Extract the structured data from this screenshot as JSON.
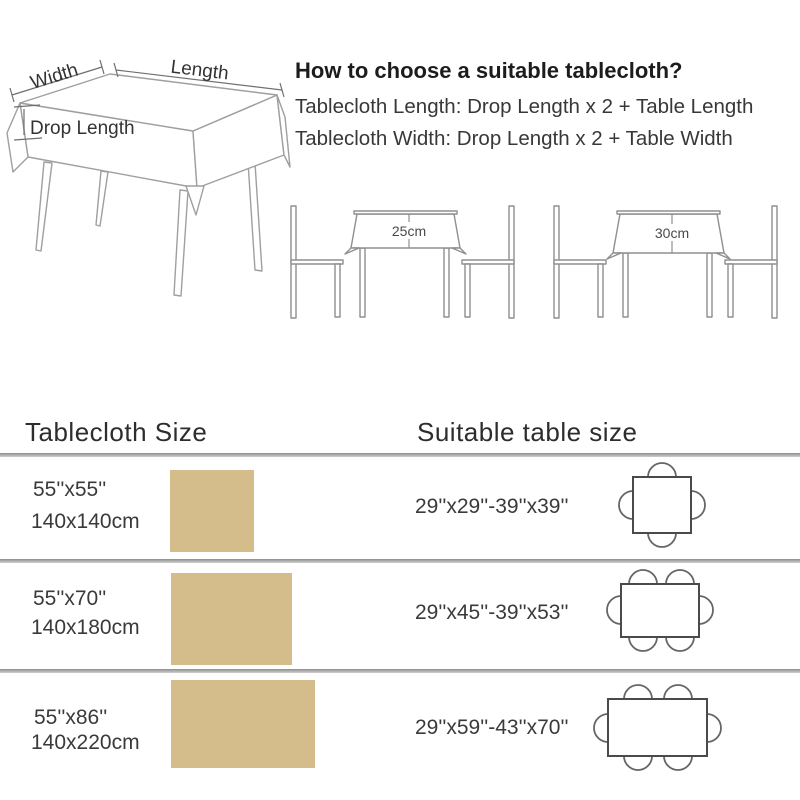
{
  "header": {
    "title": "How to choose a suitable tablecloth?",
    "formula_length": "Tablecloth Length: Drop Length x 2 + Table Length",
    "formula_width": "Tablecloth Width: Drop Length x 2 + Table Width"
  },
  "hero_diagram": {
    "width_label": "Width",
    "length_label": "Length",
    "drop_label": "Drop Length"
  },
  "drop_examples": [
    {
      "label": "25cm"
    },
    {
      "label": "30cm"
    }
  ],
  "size_chart": {
    "tablecloth_header": "Tablecloth Size",
    "suitable_header": "Suitable table size",
    "rows": [
      {
        "inches": "55''x55''",
        "cm": "140x140cm",
        "suitable": "29''x29''-39''x39''",
        "table_shape": "square",
        "chairs": 4
      },
      {
        "inches": "55''x70''",
        "cm": "140x180cm",
        "suitable": "29''x45''-39''x53''",
        "table_shape": "rectangle",
        "chairs": 6
      },
      {
        "inches": "55''x86''",
        "cm": "140x220cm",
        "suitable": "29''x59''-43''x70''",
        "table_shape": "long-rectangle",
        "chairs": 6
      }
    ]
  },
  "colors": {
    "swatch_tan": "#d5bc8b",
    "line_art_gray": "#9a9a9a",
    "divider_gray": "#8e8e8e"
  }
}
